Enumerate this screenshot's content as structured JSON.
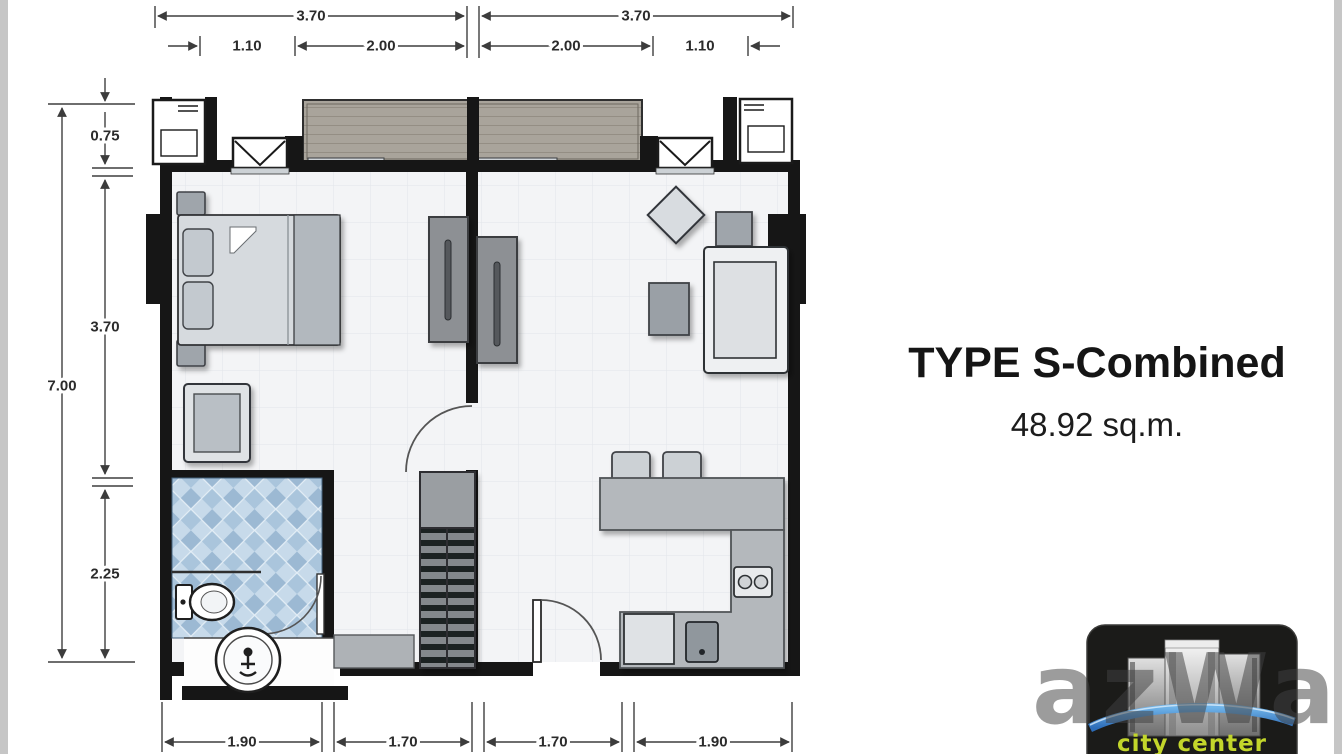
{
  "panel": {
    "title": "TYPE S-Combined",
    "area": "48.92 sq.m."
  },
  "dimensions": {
    "top_total": [
      "3.70",
      "3.70"
    ],
    "top_inner": [
      "1.10",
      "2.00",
      "2.00",
      "1.10"
    ],
    "left_total": "7.00",
    "left_inner": [
      "0.75",
      "3.70",
      "2.25"
    ],
    "bottom": [
      "1.90",
      "1.70",
      "1.70",
      "1.90"
    ]
  },
  "watermark": {
    "text": "azWaz"
  },
  "logo": {
    "caption": "city center"
  },
  "plan": {
    "fixtures": [
      "balcony-wood-deck",
      "balcony-divider",
      "sliding-door",
      "bay-window",
      "air-conditioner-unit",
      "double-bed",
      "pillow",
      "nightstand",
      "wardrobe",
      "armchair",
      "tv-cabinet",
      "coffee-table",
      "side-table",
      "sofa",
      "ottoman",
      "shelf-unit",
      "bathroom-tiles",
      "toilet",
      "round-washbasin",
      "shower-door",
      "vanity-counter",
      "kitchen-island",
      "kitchen-l-counter",
      "bar-stool",
      "two-burner-stove",
      "kitchen-sink",
      "appliance",
      "entrance-door",
      "interior-door",
      "structural-column"
    ]
  },
  "colors": {
    "wall": "#161616",
    "floor": "#f3f4f6",
    "grid": "#e2e5e9",
    "tile_blue_light": "#c7daea",
    "tile_blue_dark": "#9cb9d3",
    "wood": "#a9a49b",
    "furniture_gray": "#8d9094",
    "counter_gray": "#b4b8bc",
    "accent_green": "#c3d62b",
    "swoosh_blue": "#2c6cb8",
    "logo_bg": "#1b1b19"
  }
}
